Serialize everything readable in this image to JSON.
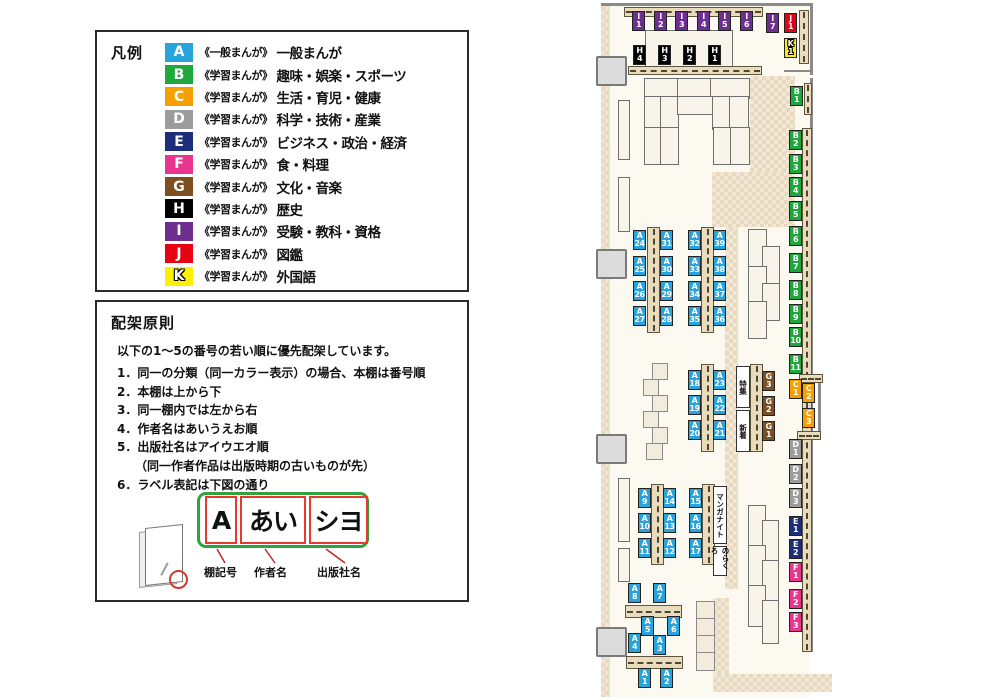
{
  "legend": {
    "title": "凡例",
    "items": [
      {
        "letter": "A",
        "color": "#29a3dc",
        "series": "《一般まんが》",
        "category": "一般まんが"
      },
      {
        "letter": "B",
        "color": "#1ea73c",
        "series": "《学習まんが》",
        "category": "趣味・娯楽・スポーツ"
      },
      {
        "letter": "C",
        "color": "#f5a000",
        "series": "《学習まんが》",
        "category": "生活・育児・健康"
      },
      {
        "letter": "D",
        "color": "#9c9c9d",
        "series": "《学習まんが》",
        "category": "科学・技術・産業"
      },
      {
        "letter": "E",
        "color": "#1d2e7b",
        "series": "《学習まんが》",
        "category": "ビジネス・政治・経済"
      },
      {
        "letter": "F",
        "color": "#e9358f",
        "series": "《学習まんが》",
        "category": "食・料理"
      },
      {
        "letter": "G",
        "color": "#7c4e20",
        "series": "《学習まんが》",
        "category": "文化・音楽"
      },
      {
        "letter": "H",
        "color": "#000000",
        "series": "《学習まんが》",
        "category": "歴史"
      },
      {
        "letter": "I",
        "color": "#6c2f8f",
        "series": "《学習まんが》",
        "category": "受験・教科・資格"
      },
      {
        "letter": "J",
        "color": "#e60012",
        "series": "《学習まんが》",
        "category": "図鑑"
      },
      {
        "letter": "K",
        "color": "#fff000",
        "series": "《学習まんが》",
        "category": "外国語"
      }
    ]
  },
  "principles": {
    "title": "配架原則",
    "intro": "以下の1～5の番号の若い順に優先配架しています。",
    "rules": [
      "1．同一の分類（同一カラー表示）の場合、本棚は番号順",
      "2．本棚は上から下",
      "3．同一棚内では左から右",
      "4．作者名はあいうえお順",
      "5．出版社名はアイウエオ順",
      "　　（同一作者作品は出版時期の古いものが先）",
      "6．ラベル表記は下図の通り"
    ],
    "label_diagram": {
      "boxes": [
        "A",
        "あい",
        "シヨ"
      ],
      "captions": [
        "棚記号",
        "作者名",
        "出版社名"
      ]
    }
  },
  "map": {
    "colors": {
      "A": "#29a3dc",
      "B": "#1ea73c",
      "C": "#f5a000",
      "D": "#9c9c9d",
      "E": "#1d2e7b",
      "F": "#e9358f",
      "G": "#7c4e20",
      "H": "#000000",
      "I": "#6c2f8f",
      "J": "#e60012",
      "K": "#fff000"
    },
    "shelf_labels": [
      {
        "letter": "I",
        "num": "1",
        "x": 632,
        "y": 11
      },
      {
        "letter": "I",
        "num": "2",
        "x": 654,
        "y": 11
      },
      {
        "letter": "I",
        "num": "3",
        "x": 675,
        "y": 11
      },
      {
        "letter": "I",
        "num": "4",
        "x": 697,
        "y": 11
      },
      {
        "letter": "I",
        "num": "5",
        "x": 718,
        "y": 11
      },
      {
        "letter": "I",
        "num": "6",
        "x": 740,
        "y": 11
      },
      {
        "letter": "I",
        "num": "7",
        "x": 766,
        "y": 13
      },
      {
        "letter": "J",
        "num": "1",
        "x": 784,
        "y": 13
      },
      {
        "letter": "K",
        "num": "1",
        "x": 784,
        "y": 38
      },
      {
        "letter": "H",
        "num": "4",
        "x": 633,
        "y": 45
      },
      {
        "letter": "H",
        "num": "3",
        "x": 658,
        "y": 45
      },
      {
        "letter": "H",
        "num": "2",
        "x": 683,
        "y": 45
      },
      {
        "letter": "H",
        "num": "1",
        "x": 708,
        "y": 45
      },
      {
        "letter": "B",
        "num": "1",
        "x": 790,
        "y": 86
      },
      {
        "letter": "B",
        "num": "2",
        "x": 789,
        "y": 130
      },
      {
        "letter": "B",
        "num": "3",
        "x": 789,
        "y": 154
      },
      {
        "letter": "B",
        "num": "4",
        "x": 789,
        "y": 177
      },
      {
        "letter": "B",
        "num": "5",
        "x": 789,
        "y": 201
      },
      {
        "letter": "B",
        "num": "6",
        "x": 789,
        "y": 226
      },
      {
        "letter": "B",
        "num": "7",
        "x": 789,
        "y": 253
      },
      {
        "letter": "B",
        "num": "8",
        "x": 789,
        "y": 280
      },
      {
        "letter": "B",
        "num": "9",
        "x": 789,
        "y": 304
      },
      {
        "letter": "B",
        "num": "10",
        "x": 789,
        "y": 327
      },
      {
        "letter": "B",
        "num": "11",
        "x": 789,
        "y": 354
      },
      {
        "letter": "C",
        "num": "1",
        "x": 789,
        "y": 379
      },
      {
        "letter": "C",
        "num": "2",
        "x": 802,
        "y": 383
      },
      {
        "letter": "C",
        "num": "3",
        "x": 802,
        "y": 408
      },
      {
        "letter": "D",
        "num": "1",
        "x": 789,
        "y": 439
      },
      {
        "letter": "D",
        "num": "2",
        "x": 789,
        "y": 464
      },
      {
        "letter": "D",
        "num": "3",
        "x": 789,
        "y": 488
      },
      {
        "letter": "E",
        "num": "1",
        "x": 789,
        "y": 516
      },
      {
        "letter": "E",
        "num": "2",
        "x": 789,
        "y": 539
      },
      {
        "letter": "F",
        "num": "1",
        "x": 789,
        "y": 562
      },
      {
        "letter": "F",
        "num": "2",
        "x": 789,
        "y": 589
      },
      {
        "letter": "F",
        "num": "3",
        "x": 789,
        "y": 612
      },
      {
        "letter": "G",
        "num": "3",
        "x": 762,
        "y": 371
      },
      {
        "letter": "G",
        "num": "2",
        "x": 762,
        "y": 396
      },
      {
        "letter": "G",
        "num": "1",
        "x": 762,
        "y": 421
      },
      {
        "letter": "A",
        "num": "24",
        "x": 633,
        "y": 230
      },
      {
        "letter": "A",
        "num": "25",
        "x": 633,
        "y": 256
      },
      {
        "letter": "A",
        "num": "26",
        "x": 633,
        "y": 281
      },
      {
        "letter": "A",
        "num": "27",
        "x": 633,
        "y": 306
      },
      {
        "letter": "A",
        "num": "31",
        "x": 660,
        "y": 230
      },
      {
        "letter": "A",
        "num": "30",
        "x": 660,
        "y": 256
      },
      {
        "letter": "A",
        "num": "29",
        "x": 660,
        "y": 281
      },
      {
        "letter": "A",
        "num": "28",
        "x": 660,
        "y": 306
      },
      {
        "letter": "A",
        "num": "32",
        "x": 688,
        "y": 230
      },
      {
        "letter": "A",
        "num": "33",
        "x": 688,
        "y": 256
      },
      {
        "letter": "A",
        "num": "34",
        "x": 688,
        "y": 281
      },
      {
        "letter": "A",
        "num": "35",
        "x": 688,
        "y": 306
      },
      {
        "letter": "A",
        "num": "39",
        "x": 713,
        "y": 230
      },
      {
        "letter": "A",
        "num": "38",
        "x": 713,
        "y": 256
      },
      {
        "letter": "A",
        "num": "37",
        "x": 713,
        "y": 281
      },
      {
        "letter": "A",
        "num": "36",
        "x": 713,
        "y": 306
      },
      {
        "letter": "A",
        "num": "18",
        "x": 688,
        "y": 370
      },
      {
        "letter": "A",
        "num": "19",
        "x": 688,
        "y": 395
      },
      {
        "letter": "A",
        "num": "20",
        "x": 688,
        "y": 420
      },
      {
        "letter": "A",
        "num": "23",
        "x": 713,
        "y": 370
      },
      {
        "letter": "A",
        "num": "22",
        "x": 713,
        "y": 395
      },
      {
        "letter": "A",
        "num": "21",
        "x": 713,
        "y": 420
      },
      {
        "letter": "A",
        "num": "9",
        "x": 638,
        "y": 488
      },
      {
        "letter": "A",
        "num": "10",
        "x": 638,
        "y": 513
      },
      {
        "letter": "A",
        "num": "11",
        "x": 638,
        "y": 538
      },
      {
        "letter": "A",
        "num": "14",
        "x": 663,
        "y": 488
      },
      {
        "letter": "A",
        "num": "13",
        "x": 663,
        "y": 513
      },
      {
        "letter": "A",
        "num": "12",
        "x": 663,
        "y": 538
      },
      {
        "letter": "A",
        "num": "15",
        "x": 689,
        "y": 488
      },
      {
        "letter": "A",
        "num": "16",
        "x": 689,
        "y": 513
      },
      {
        "letter": "A",
        "num": "17",
        "x": 689,
        "y": 538
      },
      {
        "letter": "A",
        "num": "8",
        "x": 628,
        "y": 583
      },
      {
        "letter": "A",
        "num": "7",
        "x": 653,
        "y": 583
      },
      {
        "letter": "A",
        "num": "5",
        "x": 641,
        "y": 616
      },
      {
        "letter": "A",
        "num": "6",
        "x": 667,
        "y": 616
      },
      {
        "letter": "A",
        "num": "4",
        "x": 628,
        "y": 633
      },
      {
        "letter": "A",
        "num": "3",
        "x": 653,
        "y": 635
      },
      {
        "letter": "A",
        "num": "1",
        "x": 638,
        "y": 668
      },
      {
        "letter": "A",
        "num": "2",
        "x": 660,
        "y": 668
      }
    ],
    "panels": [
      {
        "text": "特集",
        "x": 736,
        "y": 366,
        "w": 14,
        "h": 42
      },
      {
        "text": "新着",
        "x": 736,
        "y": 410,
        "w": 14,
        "h": 42
      },
      {
        "text": "マンガナイト",
        "x": 713,
        "y": 486,
        "w": 14,
        "h": 58
      },
      {
        "text": "のらくろ",
        "x": 713,
        "y": 546,
        "w": 14,
        "h": 30
      }
    ]
  }
}
